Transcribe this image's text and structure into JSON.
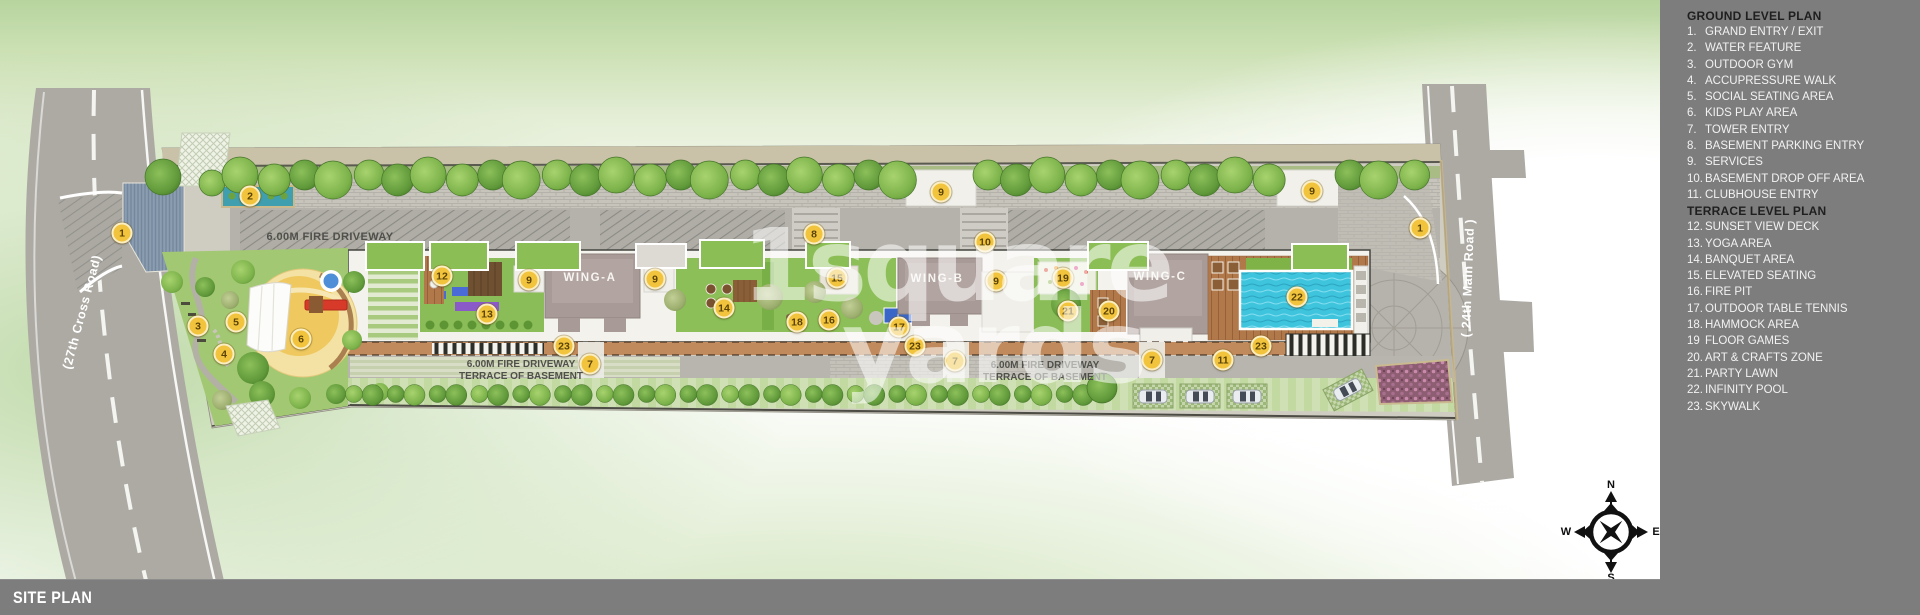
{
  "page": {
    "footer_label": "SITE PLAN"
  },
  "watermark": {
    "line1": "1square",
    "line2": "yards"
  },
  "legend": {
    "sections": [
      {
        "header": "GROUND LEVEL PLAN",
        "items": [
          {
            "num": "1.",
            "label": "GRAND ENTRY / EXIT"
          },
          {
            "num": "2.",
            "label": "WATER FEATURE"
          },
          {
            "num": "3.",
            "label": "OUTDOOR GYM"
          },
          {
            "num": "4.",
            "label": "ACCUPRESSURE WALK"
          },
          {
            "num": "5.",
            "label": "SOCIAL SEATING AREA"
          },
          {
            "num": "6.",
            "label": "KIDS PLAY AREA"
          },
          {
            "num": "7.",
            "label": "TOWER ENTRY"
          },
          {
            "num": "8.",
            "label": "BASEMENT PARKING ENTRY"
          },
          {
            "num": "9.",
            "label": "SERVICES"
          },
          {
            "num": "10.",
            "label": "BASEMENT DROP OFF AREA"
          },
          {
            "num": "11.",
            "label": "CLUBHOUSE ENTRY"
          }
        ]
      },
      {
        "header": "TERRACE LEVEL PLAN",
        "items": [
          {
            "num": "12.",
            "label": "SUNSET VIEW DECK"
          },
          {
            "num": "13.",
            "label": "YOGA AREA"
          },
          {
            "num": "14.",
            "label": "BANQUET AREA"
          },
          {
            "num": "15.",
            "label": "ELEVATED SEATING"
          },
          {
            "num": "16.",
            "label": "FIRE PIT"
          },
          {
            "num": "17.",
            "label": "OUTDOOR TABLE TENNIS"
          },
          {
            "num": "18.",
            "label": "HAMMOCK AREA"
          },
          {
            "num": "19",
            "label": "FLOOR GAMES"
          },
          {
            "num": "20.",
            "label": "ART & CRAFTS ZONE"
          },
          {
            "num": "21.",
            "label": "PARTY LAWN"
          },
          {
            "num": "22.",
            "label": "INFINITY POOL"
          },
          {
            "num": "23.",
            "label": "SKYWALK"
          }
        ]
      }
    ]
  },
  "plan": {
    "road_left_label": "(27th Cross Road)",
    "road_right_label": "( 24th Main Road )",
    "fire_driveway_label": "6.00M FIRE DRIVEWAY",
    "terrace_basement_label": "TERRACE OF BASEMENT",
    "wings": [
      "WING-A",
      "WING-B",
      "WING-C"
    ],
    "compass": {
      "n": "N",
      "s": "S",
      "e": "E",
      "w": "W"
    },
    "markers": [
      {
        "n": "1",
        "x": 122,
        "y": 233
      },
      {
        "n": "2",
        "x": 250,
        "y": 196
      },
      {
        "n": "3",
        "x": 198,
        "y": 326
      },
      {
        "n": "4",
        "x": 224,
        "y": 354
      },
      {
        "n": "5",
        "x": 236,
        "y": 322
      },
      {
        "n": "6",
        "x": 301,
        "y": 339
      },
      {
        "n": "12",
        "x": 442,
        "y": 276
      },
      {
        "n": "9",
        "x": 529,
        "y": 280
      },
      {
        "n": "13",
        "x": 487,
        "y": 314
      },
      {
        "n": "23",
        "x": 564,
        "y": 346
      },
      {
        "n": "7",
        "x": 590,
        "y": 364
      },
      {
        "n": "9",
        "x": 655,
        "y": 279
      },
      {
        "n": "14",
        "x": 724,
        "y": 308
      },
      {
        "n": "8",
        "x": 814,
        "y": 234
      },
      {
        "n": "15",
        "x": 837,
        "y": 278
      },
      {
        "n": "18",
        "x": 797,
        "y": 322
      },
      {
        "n": "16",
        "x": 829,
        "y": 320
      },
      {
        "n": "17",
        "x": 899,
        "y": 327
      },
      {
        "n": "9",
        "x": 941,
        "y": 192
      },
      {
        "n": "23",
        "x": 915,
        "y": 346
      },
      {
        "n": "7",
        "x": 955,
        "y": 361
      },
      {
        "n": "10",
        "x": 985,
        "y": 242
      },
      {
        "n": "9",
        "x": 996,
        "y": 281
      },
      {
        "n": "19",
        "x": 1063,
        "y": 278
      },
      {
        "n": "21",
        "x": 1068,
        "y": 311
      },
      {
        "n": "20",
        "x": 1109,
        "y": 311
      },
      {
        "n": "7",
        "x": 1152,
        "y": 360
      },
      {
        "n": "11",
        "x": 1223,
        "y": 360
      },
      {
        "n": "9",
        "x": 1312,
        "y": 191
      },
      {
        "n": "22",
        "x": 1297,
        "y": 297
      },
      {
        "n": "23",
        "x": 1261,
        "y": 346
      },
      {
        "n": "1",
        "x": 1420,
        "y": 228
      }
    ]
  },
  "colors": {
    "panel_gray": "#7d7d7d",
    "marker_yellow": "#f2c43d",
    "road_gray": "#adaaa4",
    "building_mauve": "#a89a96",
    "lawn_green": "#8abd58",
    "pool_cyan": "#3fc4dd",
    "background_green": "#cbe0b3"
  }
}
